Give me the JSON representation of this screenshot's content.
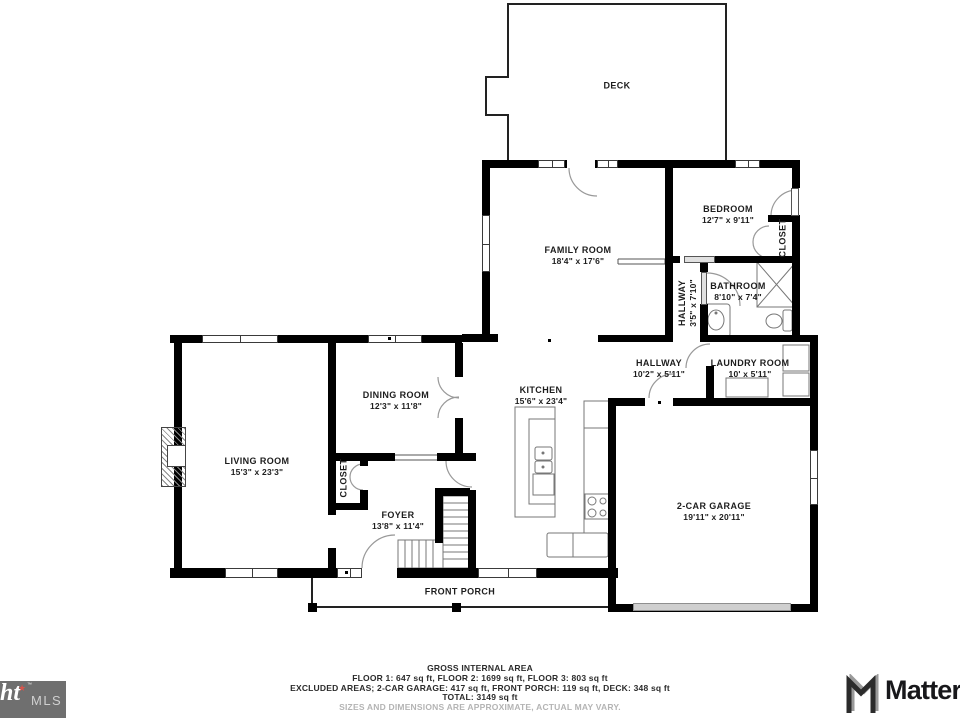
{
  "rooms": {
    "deck": {
      "name": "DECK"
    },
    "family_room": {
      "name": "FAMILY ROOM",
      "dims": "18'4\" x 17'6\""
    },
    "bedroom": {
      "name": "BEDROOM",
      "dims": "12'7\" x 9'11\""
    },
    "bedroom_closet": {
      "name": "CLOSET"
    },
    "bathroom": {
      "name": "BATHROOM",
      "dims": "8'10\" x 7'4\""
    },
    "hallway_upper": {
      "name": "HALLWAY",
      "dims": "3'5\" x 7'10\""
    },
    "hallway": {
      "name": "HALLWAY",
      "dims": "10'2\" x 5'11\""
    },
    "laundry": {
      "name": "LAUNDRY ROOM",
      "dims": "10' x 5'11\""
    },
    "dining": {
      "name": "DINING ROOM",
      "dims": "12'3\" x 11'8\""
    },
    "kitchen": {
      "name": "KITCHEN",
      "dims": "15'6\" x 23'4\""
    },
    "living": {
      "name": "LIVING ROOM",
      "dims": "15'3\" x 23'3\""
    },
    "foyer_closet": {
      "name": "CLOSET"
    },
    "foyer": {
      "name": "FOYER",
      "dims": "13'8\" x 11'4\""
    },
    "garage": {
      "name": "2-CAR GARAGE",
      "dims": "19'11\" x 20'11\""
    },
    "front_porch": {
      "name": "FRONT PORCH"
    }
  },
  "footer": {
    "title": "GROSS INTERNAL AREA",
    "floors": "FLOOR 1: 647 sq ft, FLOOR 2: 1699 sq ft, FLOOR 3: 803 sq ft",
    "excluded": "EXCLUDED AREAS; 2-CAR GARAGE: 417 sq ft, FRONT PORCH: 119 sq ft, DECK: 348 sq ft",
    "total": "TOTAL: 3149 sq ft",
    "disclaimer": "SIZES AND DIMENSIONS ARE APPROXIMATE, ACTUAL MAY VARY."
  },
  "branding": {
    "mls_word": "ht",
    "mls_star": "★",
    "mls_tm": "™",
    "mls_label": "MLS",
    "matterport": "Matterport"
  },
  "colors": {
    "wall": "#000000",
    "fixture_line": "#777777",
    "mls_box": "#6f6f6f",
    "mls_accent": "#d9534a",
    "matterport_text": "#18181b",
    "disclaimer_text": "#b4b4b4"
  }
}
